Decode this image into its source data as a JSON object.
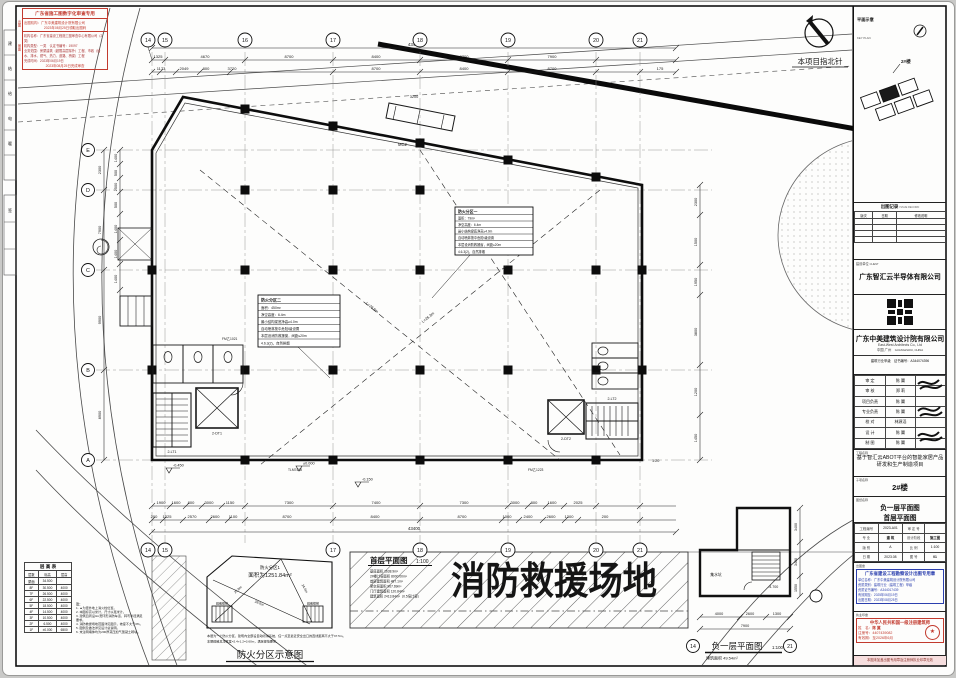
{
  "sheet": {
    "review_stamp": {
      "title": "广东省施工图数字化审查专用",
      "side_chutu": "出图",
      "side_shentu": "审图",
      "chutu_lines": [
        "出图机构：广东中美建筑设计院有限公司",
        "2023年08月25日领取出图码"
      ],
      "shentu_lines": [
        "机构名称：广东省建设工程施工图审查中心有限公司（2类）",
        "机构类型：一类　认定书编号：19097",
        "业务范围：房屋建筑（超限高层除外）工程、市政（给水、排水、燃气、热力、道路、桥梁）工程",
        "完成时间：2023年06月19日",
        "2023年08月25日完成审查"
      ]
    },
    "binding_cells": [
      "建",
      "结",
      "给",
      "电",
      "暖",
      "签"
    ],
    "north_arrow_label": "本项目指北针",
    "keyplan": {
      "label": "平面示意",
      "label_en": "KEY PLAN",
      "tag": "2#楼"
    }
  },
  "plan": {
    "big_text": "消防救援场地",
    "label_title": "首层平面图",
    "label_scale": "1:100",
    "stats": [
      "基底面积 1638.9m²",
      "2#楼计容面积 8000.00m²",
      "首层建筑面积 487.1m²",
      "架空层面积 967.69m²",
      "门厅建筑面积 120.84m²",
      "建筑面积 2413.84m²（0.5倍计容）"
    ],
    "zone_box_a": {
      "lines": [
        "防火分区二",
        "面积：450m²",
        "净空高度：6.4m",
        "最小结构梁底净高≥4.0m",
        "自动喷淋按中危险Ⅰ级设置",
        "本层设消防救援窗，间距≤20m",
        "4.6.3(2)，自然排烟"
      ]
    },
    "zone_box_b": {
      "lines": [
        "防火分区一",
        "面积：79m²",
        "净空高度：6.4m",
        "最小结构梁底净高≥4.0m",
        "自动喷淋按中危险Ⅰ级设置",
        "本层设消防救援窗，间距≤20m",
        "4.6.3(2)，自然排烟"
      ]
    },
    "axes_top": [
      "14",
      "15",
      "16",
      "17",
      "18",
      "19",
      "20",
      "21"
    ],
    "axes_left": [
      "E",
      "D",
      "C",
      "B",
      "A"
    ],
    "dims": {
      "top_total": "43400",
      "top_row1": [
        "1325",
        "4670",
        "8700",
        "8400",
        "8700",
        "7900"
      ],
      "top_row2": [
        "1173",
        "2049",
        "800",
        "3720",
        "8700",
        "8400",
        "8700",
        "175"
      ],
      "bottom_row1": [
        "1900",
        "1600",
        "800",
        "3000",
        "1150",
        "7300",
        "7400",
        "7300",
        "3000",
        "800",
        "1600",
        "2025"
      ],
      "bottom_row2": [
        "200",
        "1325",
        "2570",
        "2600",
        "1100",
        "8700",
        "8400",
        "8700",
        "1000",
        "2400",
        "2600",
        "1300",
        "200"
      ],
      "bottom_total": "43400",
      "left_row": [
        "2300",
        "7900",
        "9900",
        "8900"
      ],
      "left_subs": [
        "1400",
        "500",
        "2500",
        "500",
        "1400",
        "1400",
        "1400"
      ],
      "right_row": [
        "2300",
        "1500",
        "1950",
        "3800",
        "1200",
        "1450"
      ]
    },
    "labels": {
      "canopy": "MC2",
      "canopy_dim": "3200",
      "elev1": "2-DT1",
      "elev2": "2-DT2",
      "stair1": "2-LT1",
      "stair2": "2-LT2",
      "level1": "-0.150",
      "level2": "±0.000",
      "level3": "-0.450",
      "door1": "FM乙1223",
      "door2": "TLM7428",
      "door3": "FM乙1021",
      "ramp": "1:20",
      "diag1": "L=28.9m",
      "diag2": "L=26.3m"
    }
  },
  "fire_diagram": {
    "title": "防火分区示意图",
    "zone_name": "防火分区1",
    "zone_area": "面积为1251.84m²",
    "d1": "28.0m",
    "d2": "25.8m",
    "d3": "24.6m",
    "stair1": "疏散楼梯",
    "stair2": "疏散楼梯",
    "notes": [
      "本层为一个防火分区，建筑内全部设自动喷淋系统，任一点至最近安全出口的直线距离不大于37.5m。",
      "本层疏散总净宽度=2.4+1.2=3.60m，满足规范要求。"
    ]
  },
  "floor_table": {
    "title": "层 高 表",
    "cols": [
      "层数",
      "标高",
      "层高"
    ],
    "rows": [
      [
        "屋面",
        "34.500",
        ""
      ],
      [
        "8F",
        "30.500",
        "4000"
      ],
      [
        "7F",
        "26.500",
        "4000"
      ],
      [
        "6F",
        "22.500",
        "4000"
      ],
      [
        "5F",
        "18.500",
        "4000"
      ],
      [
        "4F",
        "14.500",
        "4000"
      ],
      [
        "3F",
        "10.500",
        "4000"
      ],
      [
        "2F",
        "6.500",
        "4000"
      ],
      [
        "1F",
        "±0.000",
        "6500"
      ]
    ]
  },
  "side_notes": {
    "title": "注：",
    "lines": [
      "1. ▲为室外地上消火栓位置。",
      "2. 本图标高以米计，尺寸以毫米计。",
      "3. 建筑四周设4m宽环形消防车道，转弯半径满足要求。",
      "4. 消防救援场地范围详见图示，坡度不大于3%。",
      "5. 图例及做法详见设计总说明。",
      "6. 未注明墙体均为200厚蒸压加气混凝土砌块。"
    ]
  },
  "basement": {
    "title": "负一层平面图",
    "scale": "1:100",
    "area": "建筑面积 49.54m²",
    "room": "集水坑",
    "level": "-4.700",
    "dims_bottom": [
      "4000",
      "2600",
      "1300"
    ],
    "dims_bottom_total": "7900",
    "dims_right": [
      "3400",
      "3400",
      "1550"
    ],
    "bubble_left": "14",
    "bubble_right": "21"
  },
  "titleblock": {
    "record": {
      "title": "出图记录",
      "title_en": "ISSUE RECORD",
      "cols": [
        "版次",
        "日期",
        "修改说明"
      ]
    },
    "client": {
      "label": "建设单位",
      "label_en": "CLIENT",
      "name": "广东智汇云半导体有限公司"
    },
    "firm": {
      "name_cn": "广东中美建筑设计院有限公司",
      "name_en": "East-West Architects Co., Ltd",
      "loc_cn": "中国 广州",
      "loc_en": "GUANGZHOU, CHINA",
      "cert": "建筑行业甲级　证书编号：A344074396"
    },
    "roles": [
      {
        "label": "审 定",
        "name": "陈 翼"
      },
      {
        "label": "审 核",
        "name": "郑 莉"
      },
      {
        "label": "项目负责",
        "name": "陈 翼"
      },
      {
        "label": "专业负责",
        "name": "陈 翼"
      },
      {
        "label": "校 对",
        "name": "林源滔"
      },
      {
        "label": "设 计",
        "name": "陈 翼"
      },
      {
        "label": "制 图",
        "name": "陈 翼"
      }
    ],
    "project": {
      "label": "工程名称",
      "name": "基于智汇云ABOT平台的智能家居产品研发和生产制造项目"
    },
    "subproject": {
      "label": "子项名称",
      "name": "2#楼"
    },
    "drawing": {
      "label": "图纸名称",
      "name1": "负一层平面图",
      "name2": "首层平面图"
    },
    "meta": [
      {
        "label": "工程编号",
        "value": "2023-A01"
      },
      {
        "label": "审 定 号",
        "value": ""
      },
      {
        "label": "专 业",
        "value": "建 筑"
      },
      {
        "label": "设计阶段",
        "value": "施工图"
      },
      {
        "label": "版 别",
        "value": "A"
      },
      {
        "label": "比 例",
        "value": "1:100"
      },
      {
        "label": "日 期",
        "value": "2023.08"
      },
      {
        "label": "图 号",
        "value": "01"
      }
    ],
    "issue_seal_label": "出图章",
    "blue_stamp": {
      "title": "广东省建设工程勘察设计出图专用章",
      "lines": [
        "单位名称：广东中美建筑设计院有限公司",
        "资质类别：建筑行业（建筑工程）甲级",
        "资质证书编号：A344017439",
        "有效期至：2025年06月19日",
        "出图日期：2023年08月25日"
      ]
    },
    "practice_seal_label": "执业印章",
    "red_stamp": {
      "title": "中华人民共和国一级注册建筑师",
      "rows": [
        {
          "label": "姓　名：",
          "value": "陈 翼"
        },
        {
          "label": "注册号：",
          "value": "4407439082"
        },
        {
          "label": "有效期：",
          "value": "至2026年6月"
        }
      ]
    },
    "footer": "本图未加盖出图专用章及注册师执业印章无效"
  }
}
